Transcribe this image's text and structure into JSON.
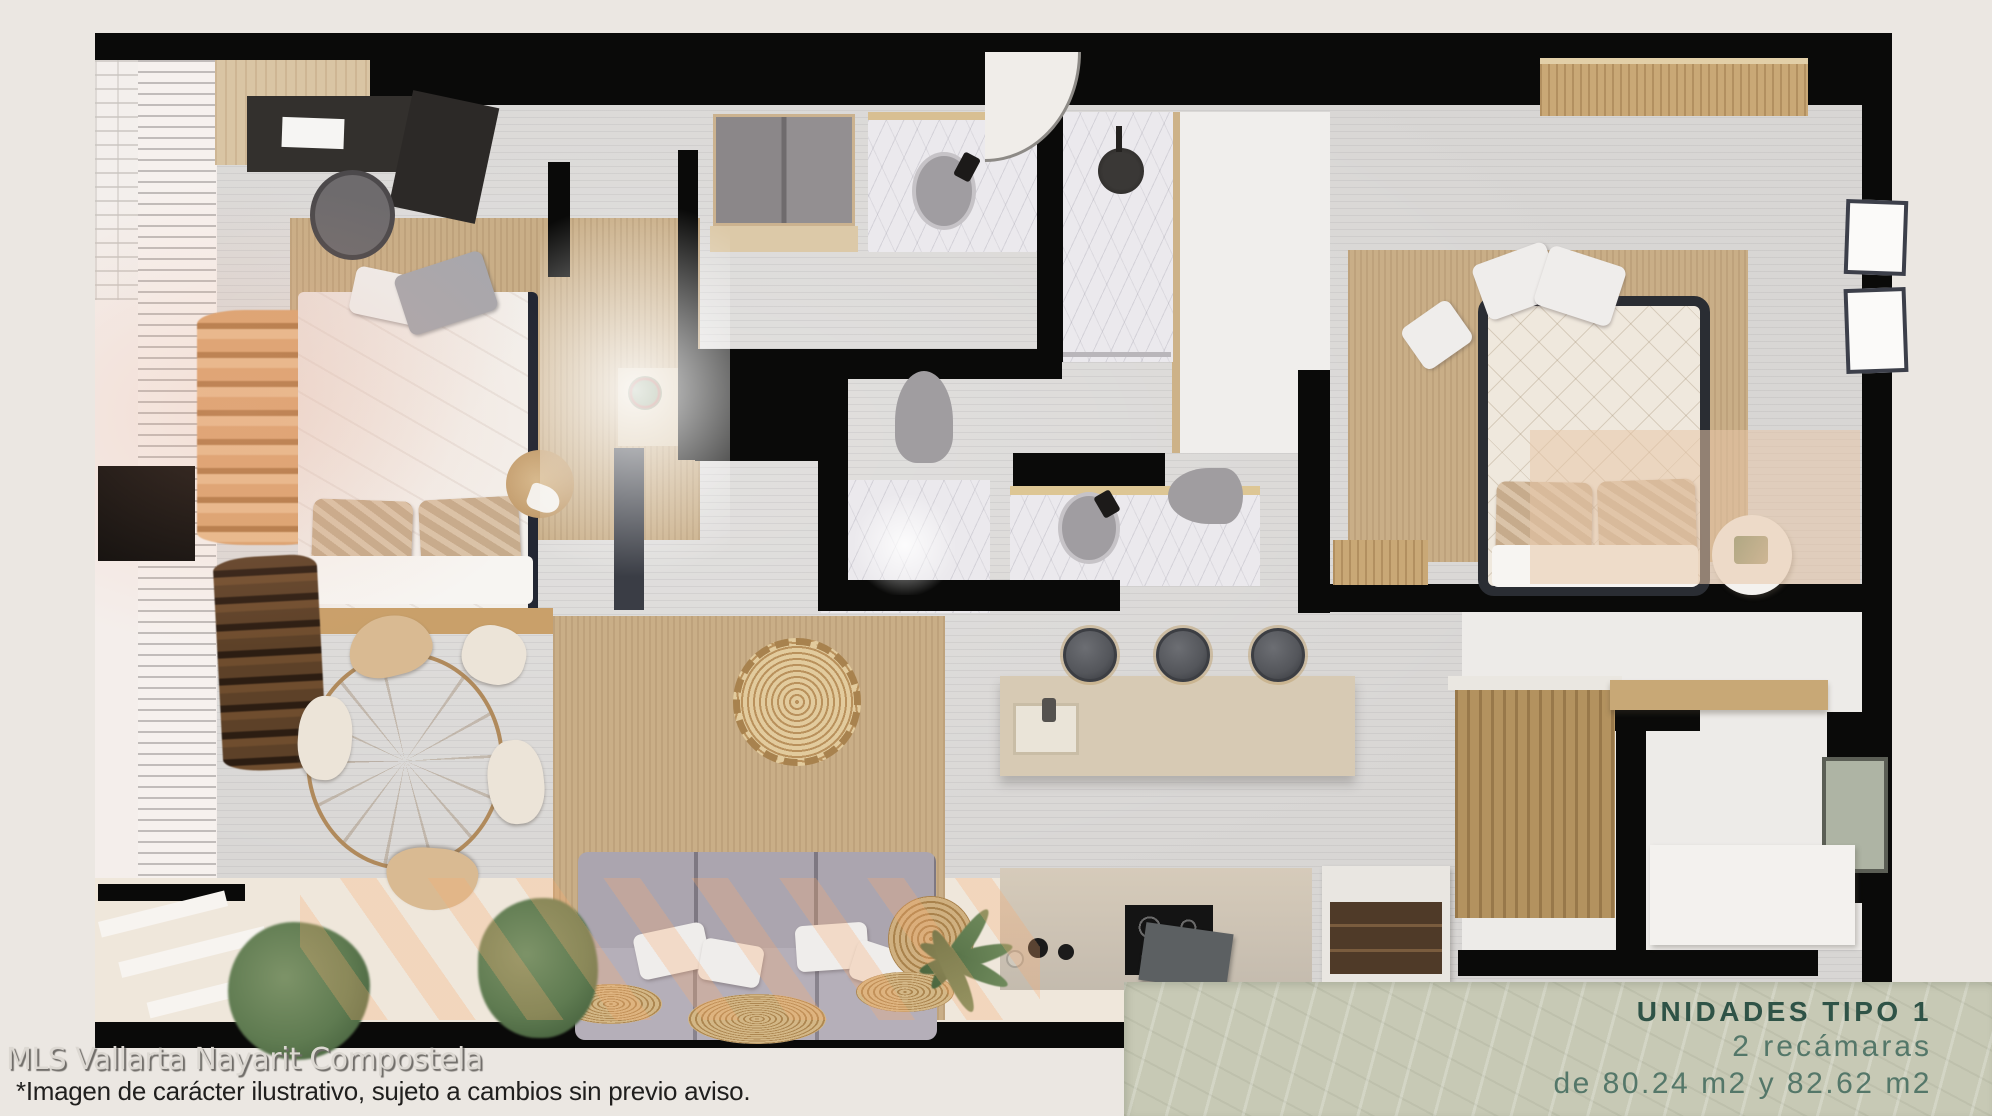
{
  "panel": {
    "title": "UNIDADES TIPO 1",
    "subtitle": "2 recámaras",
    "sizes": "de 80.24 m2 y 82.62 m2"
  },
  "footer": {
    "watermark": "MLS Vallarta Nayarit Compostela",
    "disclaimer": "*Imagen de carácter ilustrativo, sujeto a cambios sin previo aviso."
  },
  "colors": {
    "page_bg": "#ebe7e2",
    "wall": "#0a0a09",
    "floor": "#d8d6d4",
    "marble": "#ebe9ed",
    "jute": "#c9ae87",
    "wood": "#c9a876",
    "wood_light": "#d9c5a4",
    "sofa": "#aba5af",
    "stool": "#54565b",
    "plant": "#5f7b51",
    "terrace": "#efe7db",
    "panel_bg": "#c7c9b5",
    "panel_title": "#2f5347",
    "panel_text": "#547769",
    "watermark": "#dcd8d2",
    "ink": "#201f1e"
  }
}
